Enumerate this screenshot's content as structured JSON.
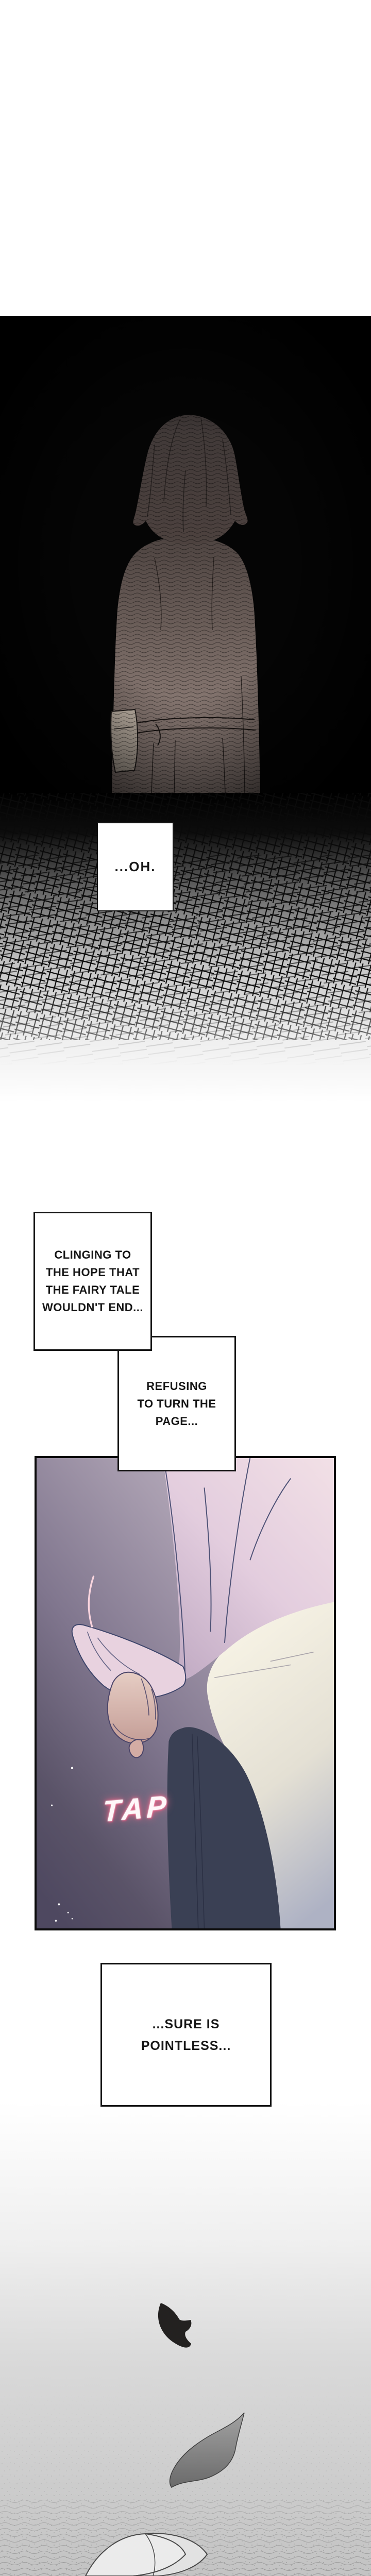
{
  "page": {
    "kind": "webtoon-episode-page",
    "background": "#ffffff"
  },
  "colors": {
    "panel-black": "#050505",
    "tap-pink": "#f06a8c",
    "art-purple-dark": "#4e4860",
    "art-purple-light": "#c8bfcc",
    "sleeve-pink": "#eedbe6",
    "blanket-white": "#f6f2e4",
    "navy-fabric": "#3a4054",
    "paper-black": "#232120",
    "paper-gray": "#8f8f8f",
    "ground-gray": "#c3c3c3"
  },
  "speech": {
    "oh": "...OH.",
    "clinging": [
      "CLINGING TO",
      "THE HOPE THAT",
      "THE FAIRY TALE",
      "WOULDN'T END..."
    ],
    "refusing": [
      "REFUSING",
      "TO TURN THE",
      "PAGE..."
    ],
    "pointless": [
      "...SURE IS",
      "POINTLESS..."
    ],
    "tap": "TAP"
  }
}
